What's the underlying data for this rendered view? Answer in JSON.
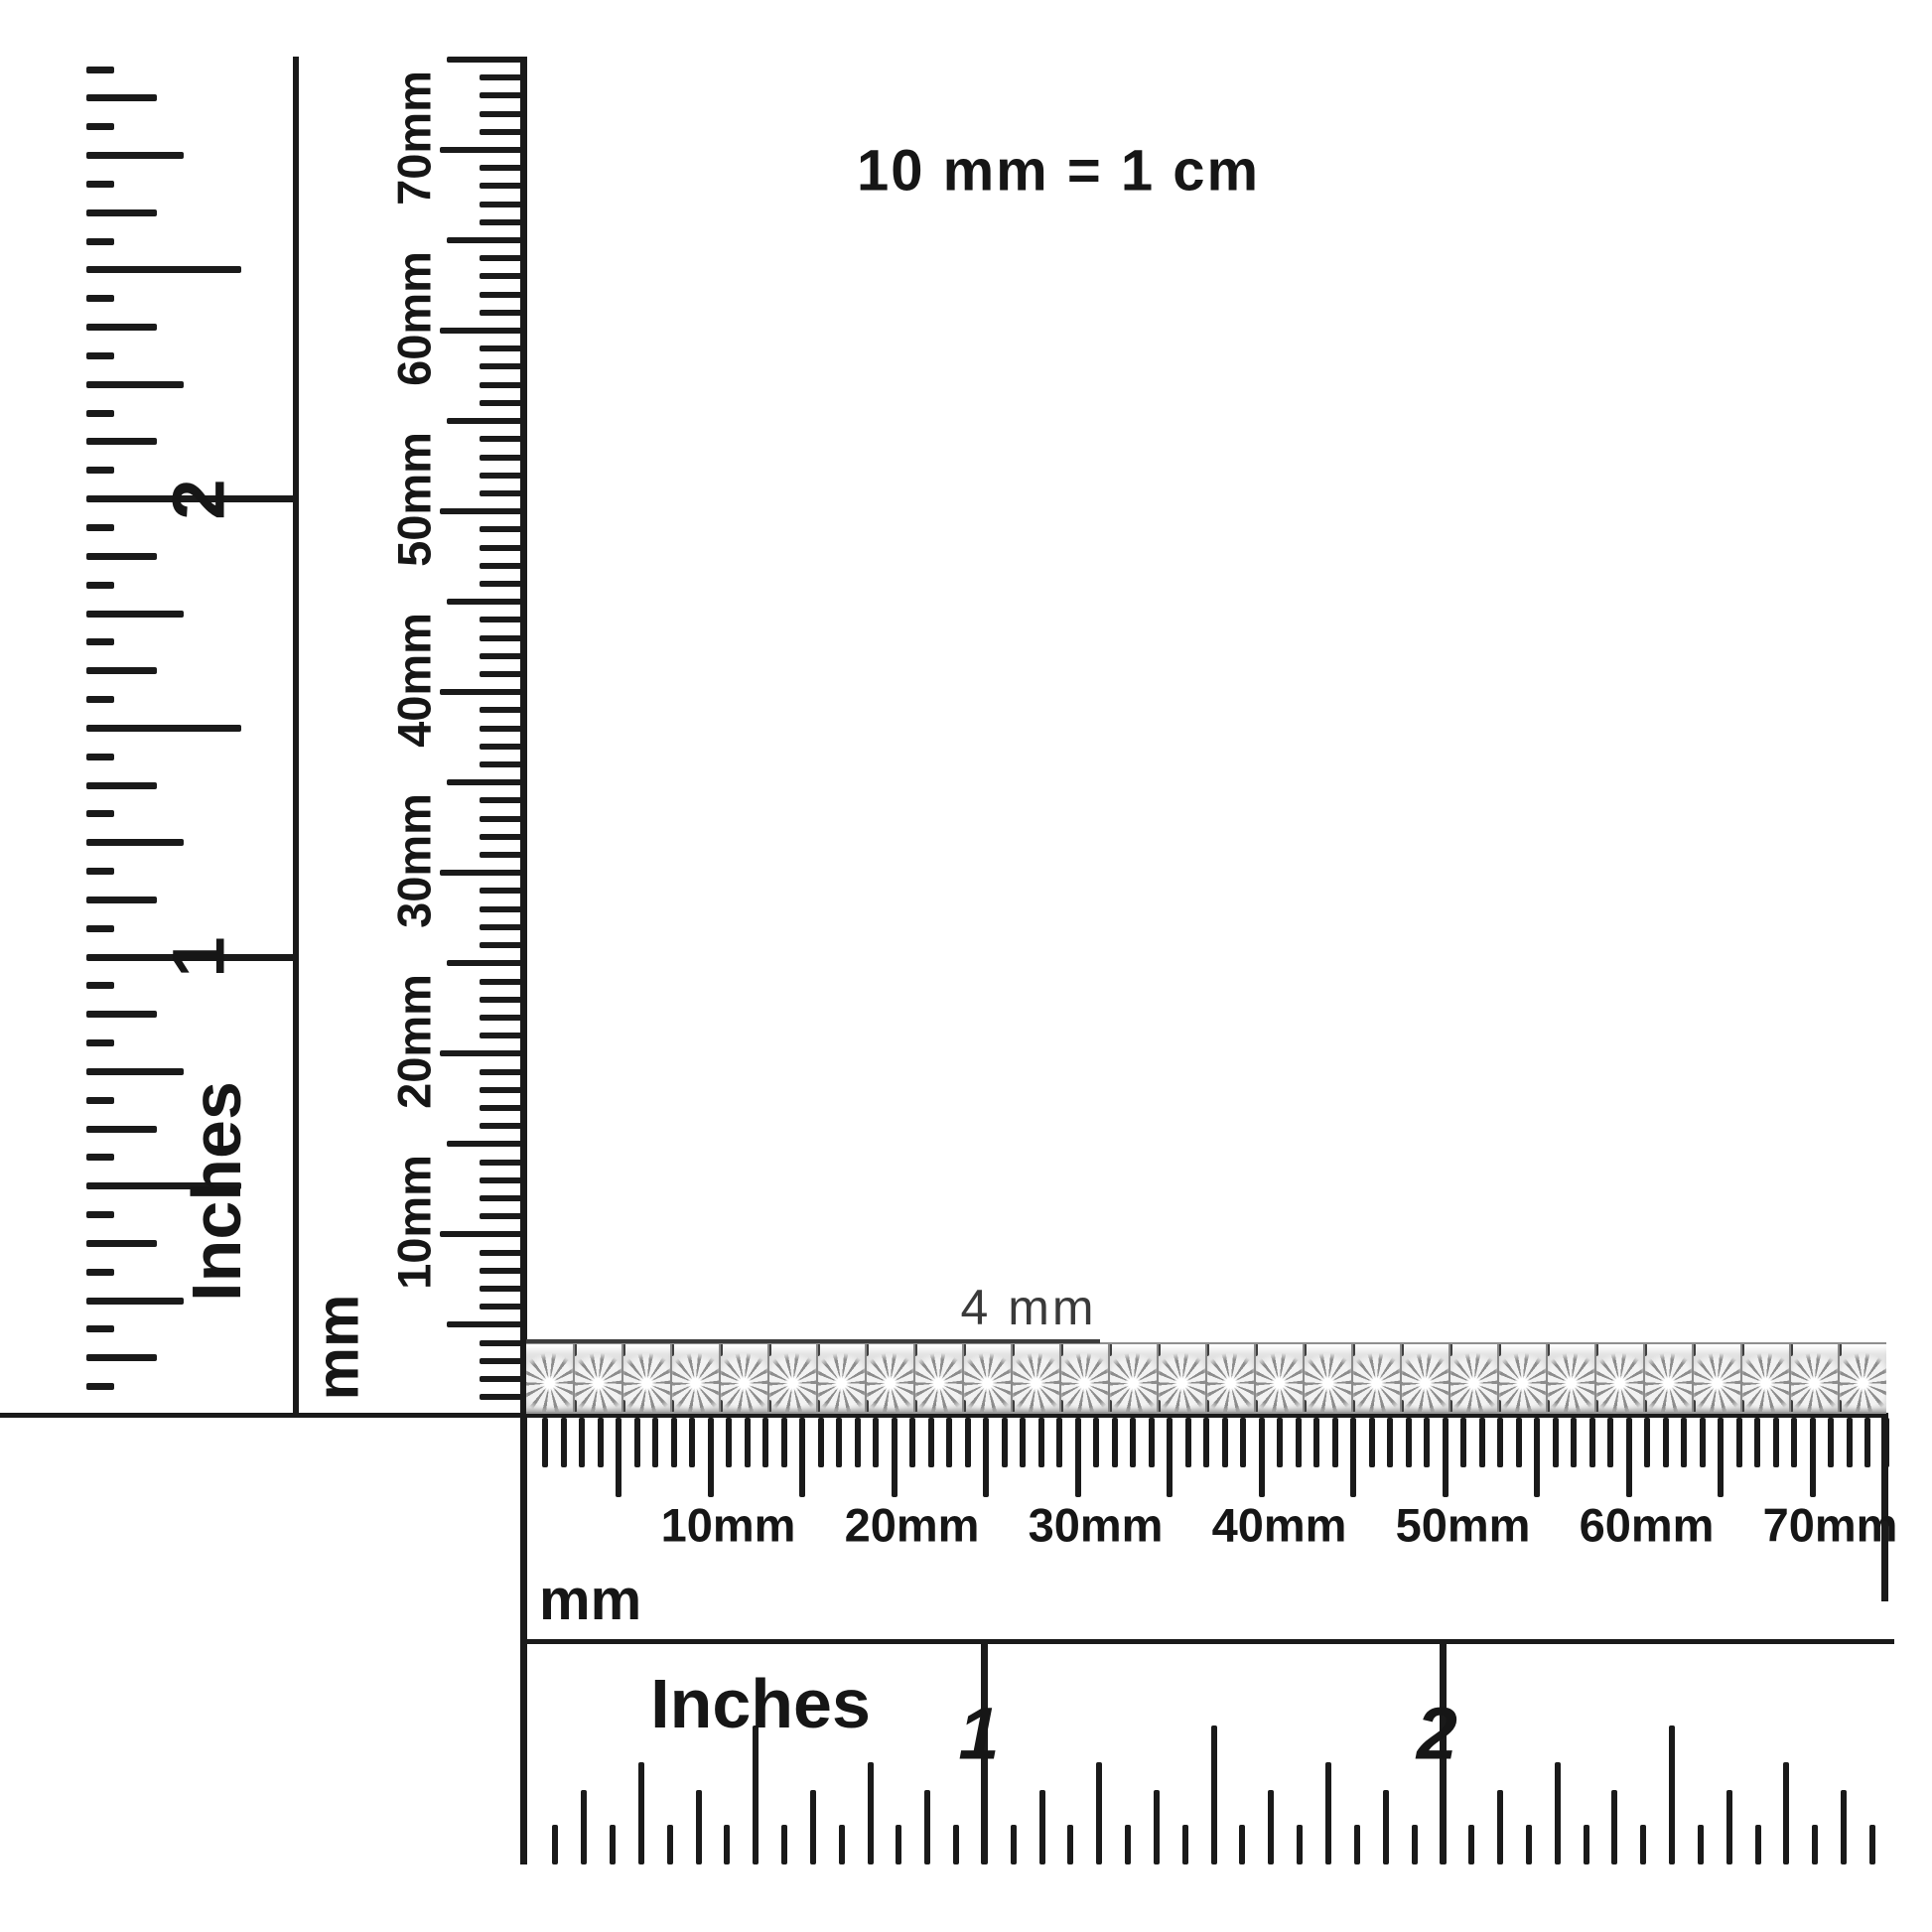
{
  "scale_note": "10 mm = 1 cm",
  "bracelet": {
    "width_label": "4 mm",
    "link_count": 28
  },
  "left_inch_ruler": {
    "unit_label": "Inches",
    "numerals": [
      {
        "value": "1",
        "inch": 1
      },
      {
        "value": "2",
        "inch": 2
      }
    ]
  },
  "left_mm_ruler": {
    "unit_label": "mm",
    "labels": [
      {
        "text": "10mm",
        "mm": 10
      },
      {
        "text": "20mm",
        "mm": 20
      },
      {
        "text": "30mm",
        "mm": 30
      },
      {
        "text": "40mm",
        "mm": 40
      },
      {
        "text": "50mm",
        "mm": 50
      },
      {
        "text": "60mm",
        "mm": 60
      },
      {
        "text": "70mm",
        "mm": 70
      }
    ]
  },
  "bottom_mm_ruler": {
    "unit_label": "mm",
    "labels": [
      {
        "text": "10mm",
        "mm": 10
      },
      {
        "text": "20mm",
        "mm": 20
      },
      {
        "text": "30mm",
        "mm": 30
      },
      {
        "text": "40mm",
        "mm": 40
      },
      {
        "text": "50mm",
        "mm": 50
      },
      {
        "text": "60mm",
        "mm": 60
      },
      {
        "text": "70mm",
        "mm": 70
      }
    ]
  },
  "bottom_inch_ruler": {
    "unit_label": "Inches",
    "numerals": [
      {
        "value": "1",
        "inch": 1
      },
      {
        "value": "2",
        "inch": 2
      }
    ]
  },
  "colors": {
    "ink": "#1a1a1a",
    "text": "#161616",
    "measure_line": "#3c3c3c",
    "bracelet_metal": "#e3e3e3",
    "bracelet_prong": "#3f3f3f"
  }
}
